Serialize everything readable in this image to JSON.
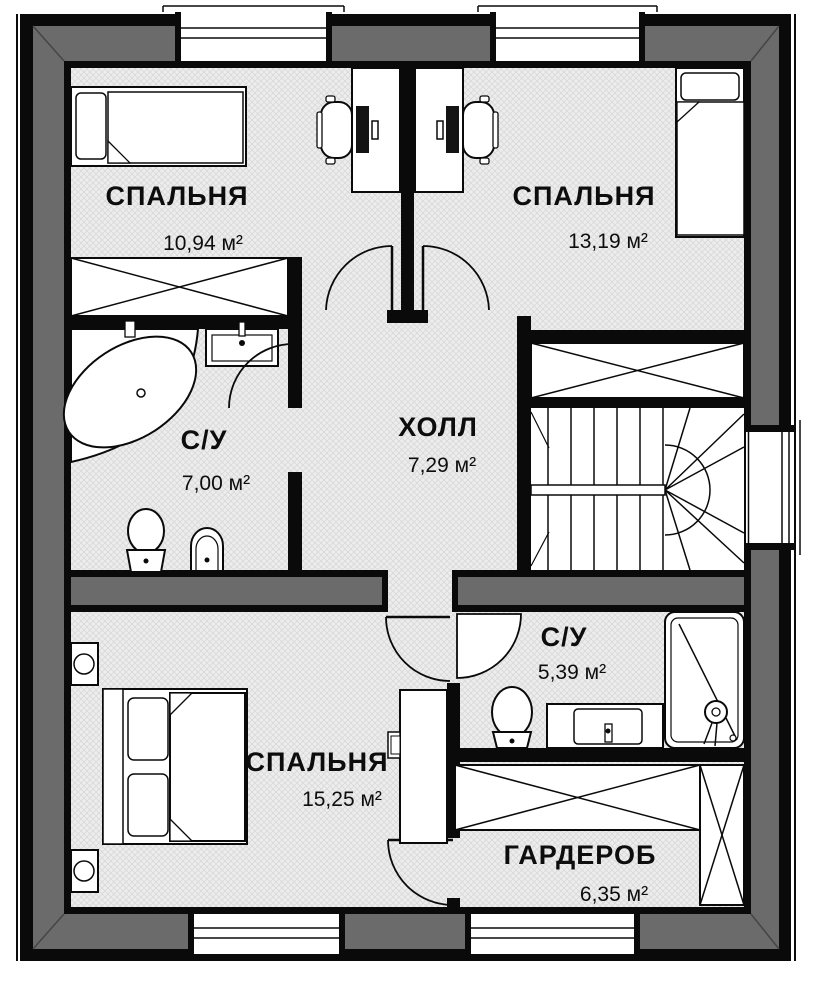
{
  "plan": {
    "type": "apartment-floor-plan",
    "language": "ru",
    "rooms": [
      {
        "id": "bedroom-top-left",
        "name": "СПАЛЬНЯ",
        "area": "10,94 м²"
      },
      {
        "id": "bedroom-top-right",
        "name": "СПАЛЬНЯ",
        "area": "13,19 м²"
      },
      {
        "id": "bathroom-left",
        "name": "С/У",
        "area": "7,00 м²"
      },
      {
        "id": "hall",
        "name": "ХОЛЛ",
        "area": "7,29 м²"
      },
      {
        "id": "bedroom-bottom",
        "name": "СПАЛЬНЯ",
        "area": "15,25 м²"
      },
      {
        "id": "bathroom-right",
        "name": "С/У",
        "area": "5,39 м²"
      },
      {
        "id": "wardrobe-room",
        "name": "ГАРДЕРОБ",
        "area": "6,35 м²"
      }
    ],
    "colors": {
      "wall_fill": "#6b6b6b",
      "line": "#0a0a0a",
      "floor_base": "#ededed",
      "floor_hatch": "#d9d9d9"
    }
  }
}
